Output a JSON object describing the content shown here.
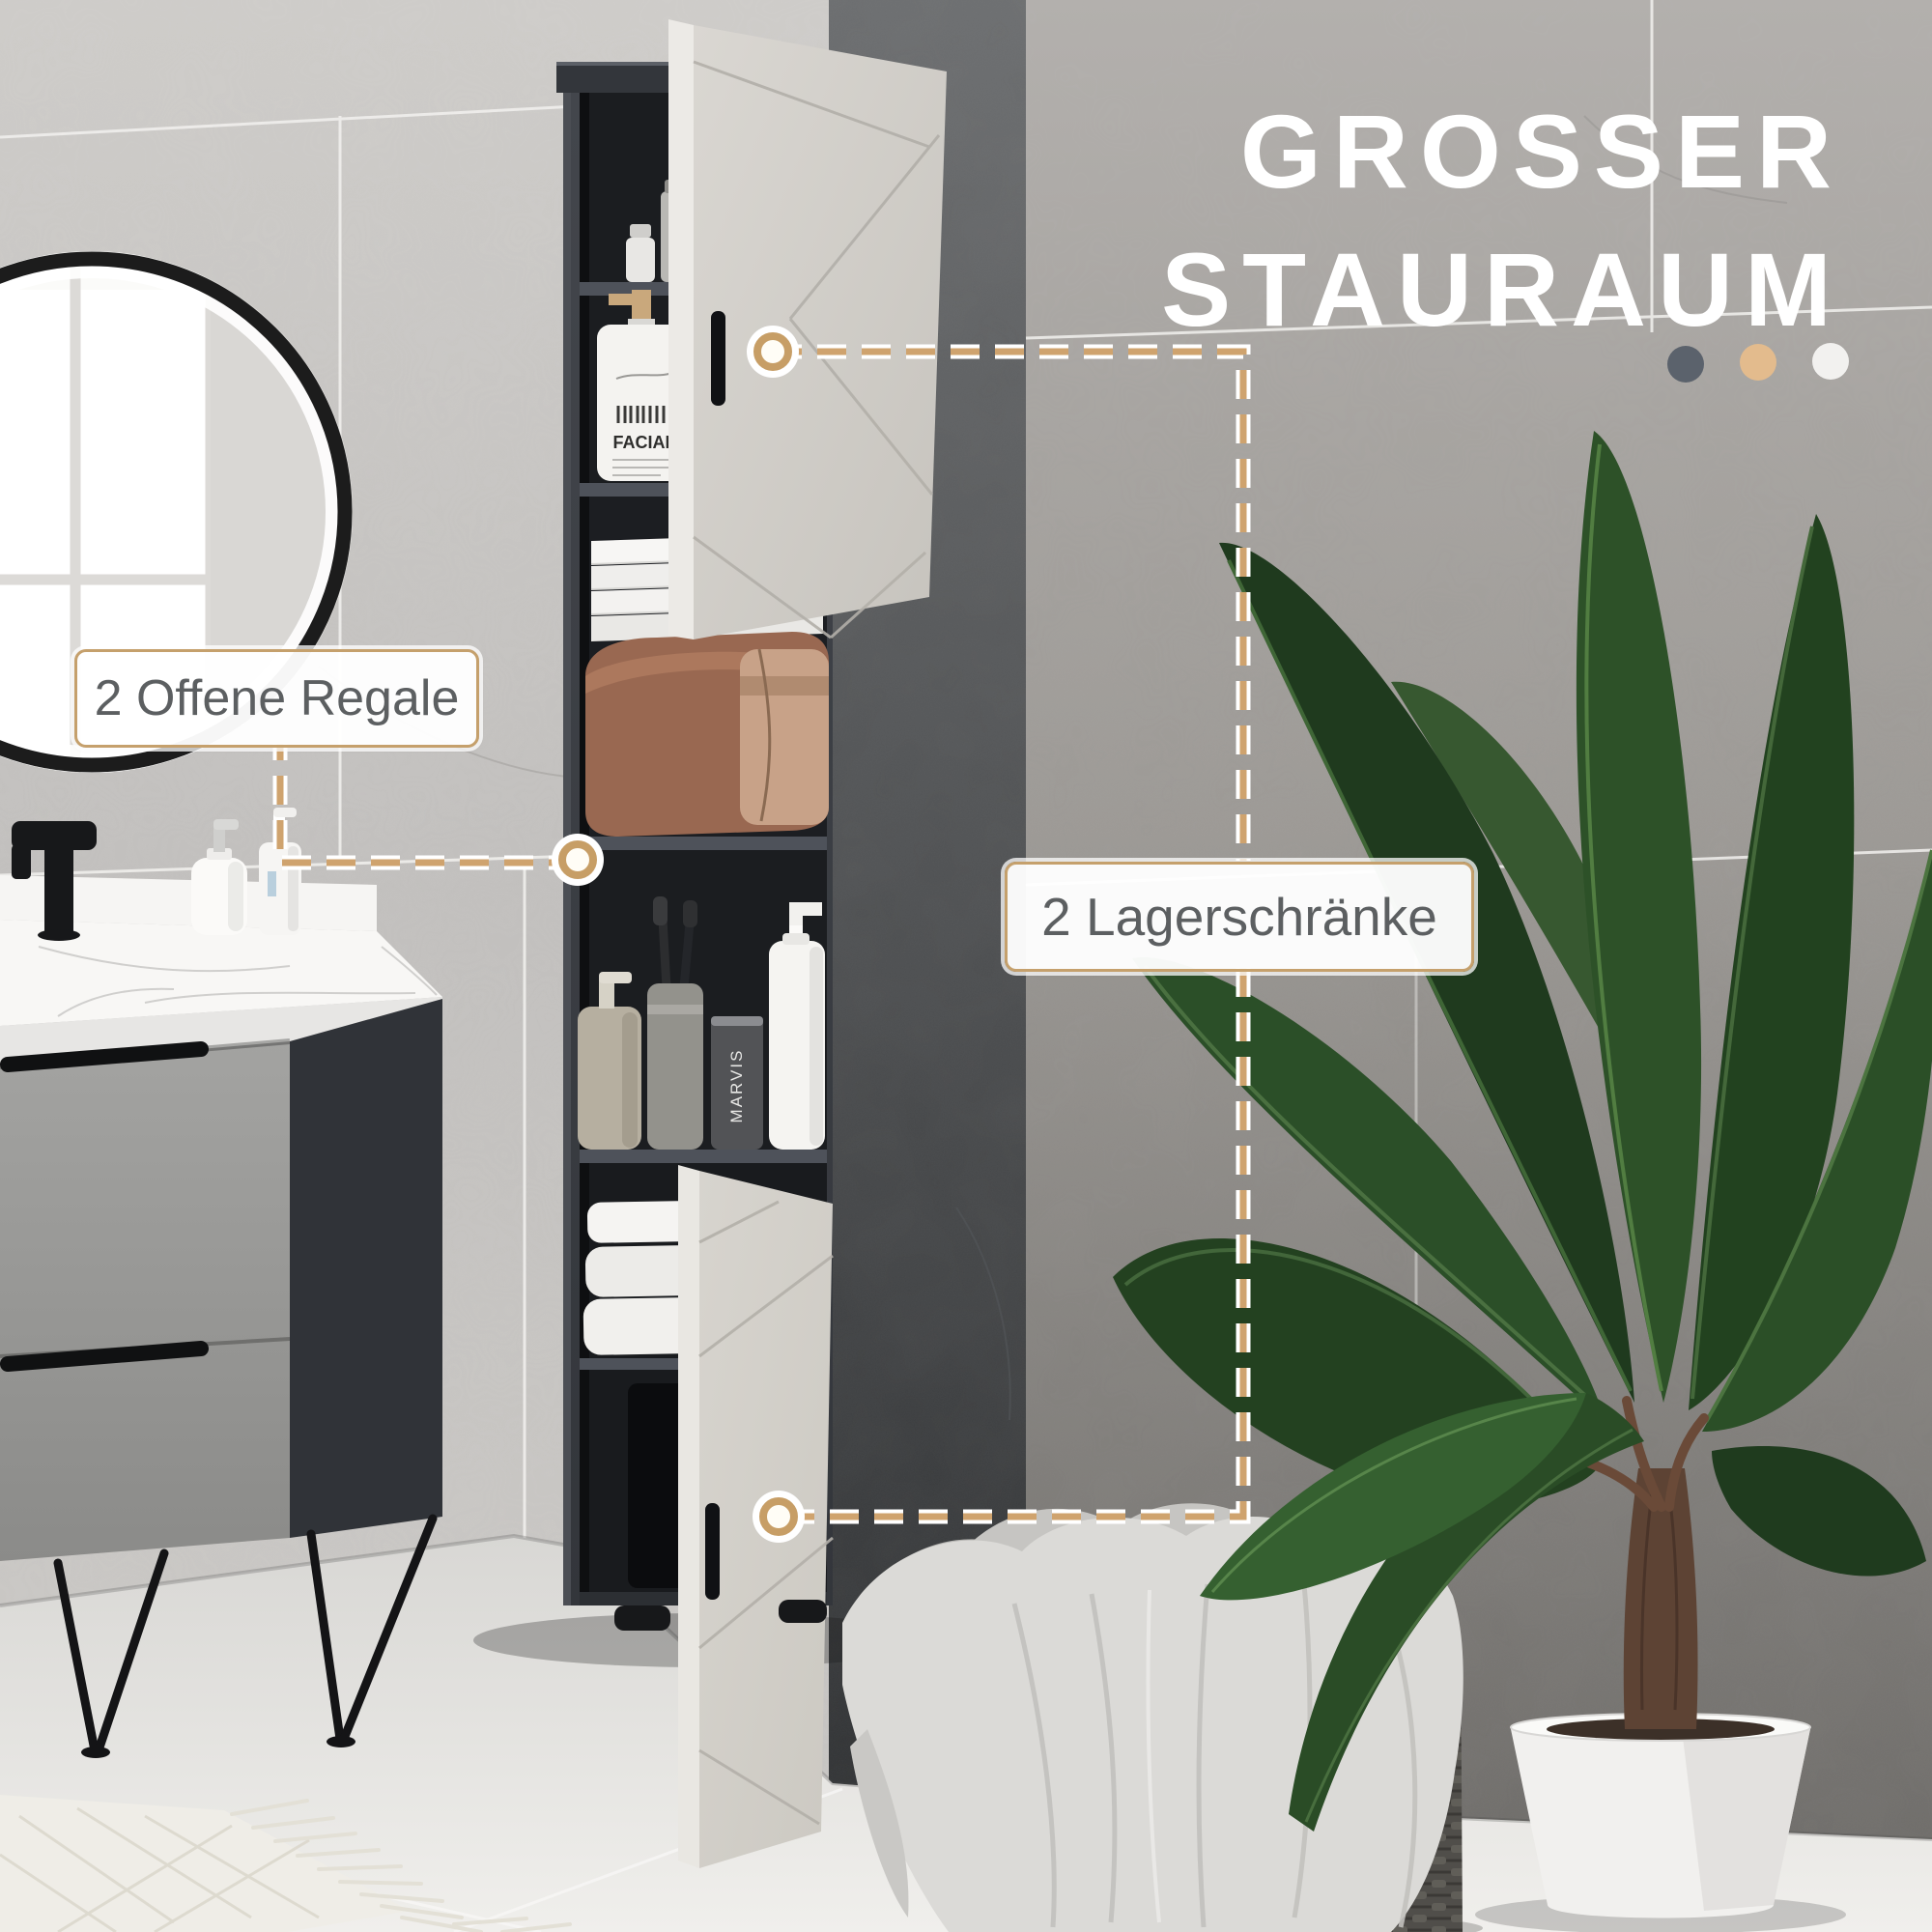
{
  "page": {
    "title": {
      "line1": "GROSSER",
      "line2": "STAURAUM"
    },
    "title_color": "#ffffff",
    "accent_color": "#c9a36e",
    "decor_dots": [
      {
        "name": "dot-dark",
        "color": "#5b626c"
      },
      {
        "name": "dot-tan",
        "color": "#e3bb8d"
      },
      {
        "name": "dot-white",
        "color": "#f2f1ef"
      }
    ],
    "callouts": [
      {
        "id": "open-shelves",
        "label": "2 Offene Regale"
      },
      {
        "id": "storage-cabinets",
        "label": "2 Lagerschränke"
      }
    ],
    "product_texts": {
      "facial_bottle": "FACIAL",
      "toothbrush_cup": "MARVIS"
    }
  }
}
